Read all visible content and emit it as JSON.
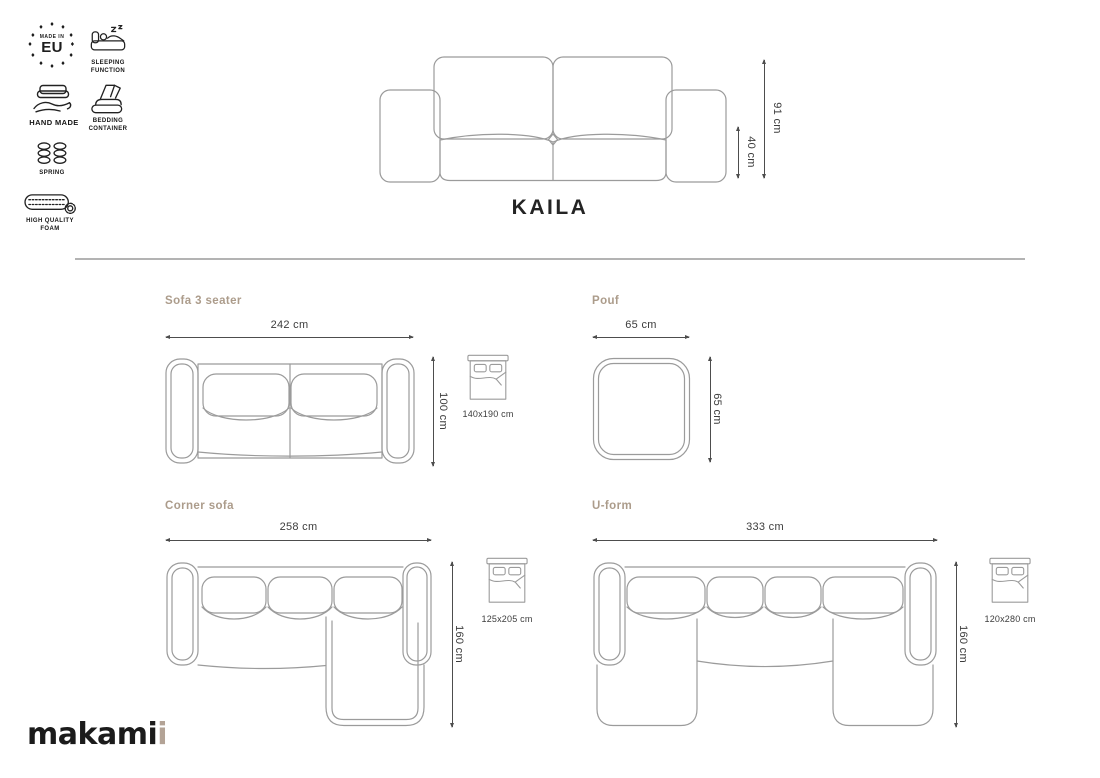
{
  "badges": [
    {
      "top": "MADE IN",
      "main": "EU"
    },
    {
      "label": "SLEEPING FUNCTION"
    },
    {
      "label": "HAND MADE"
    },
    {
      "label": "BEDDING CONTAINER"
    },
    {
      "label": "SPRING"
    },
    {
      "label": "HIGH QUALITY FOAM"
    }
  ],
  "product": {
    "title": "KAILA",
    "front": {
      "total": "91 cm",
      "seat": "40 cm"
    }
  },
  "variants": [
    {
      "name": "Sofa 3 seater",
      "width": "242 cm",
      "depth": "100 cm",
      "bed_size": "140x190 cm"
    },
    {
      "name": "Pouf",
      "width": "65 cm",
      "depth": "65 cm"
    },
    {
      "name": "Corner sofa",
      "width": "258 cm",
      "depth": "160 cm",
      "bed_size": "125x205 cm"
    },
    {
      "name": "U-form",
      "width": "333 cm",
      "depth": "160 cm",
      "bed_size": "120x280 cm"
    }
  ],
  "logo": {
    "main": "makami",
    "accent": "i"
  },
  "colors": {
    "accent_text": "#ac9c8b",
    "drawing_line": "#9b9b9b",
    "dimension_line": "#4d4d4d",
    "ink": "#1d1d1d"
  }
}
